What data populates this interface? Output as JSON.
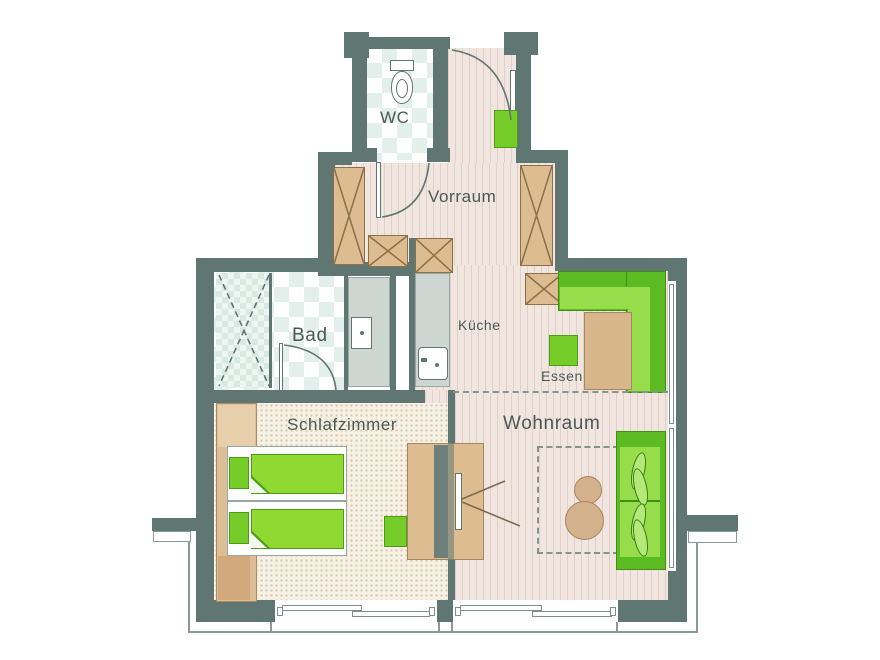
{
  "title": "Apartment floor plan",
  "rooms": [
    {
      "id": "wc",
      "label": "WC"
    },
    {
      "id": "vorraum",
      "label": "Vorraum"
    },
    {
      "id": "bad",
      "label": "Bad"
    },
    {
      "id": "kueche",
      "label": "Küche"
    },
    {
      "id": "essen",
      "label": "Essen"
    },
    {
      "id": "schlafzimmer",
      "label": "Schlafzimmer"
    },
    {
      "id": "wohnraum",
      "label": "Wohnraum"
    }
  ],
  "colors": {
    "wall": "#5F7672",
    "wood_floor": "#F1E5DF",
    "carpet": "#F6F1E4",
    "tile": "#E2EFEA",
    "furniture_tan": "#DCBC90",
    "green_bright": "#8FD932",
    "green_dark": "#5CBB22",
    "counter_gray": "#CDD6D1",
    "outline_gray": "#8A9A96",
    "text": "#4A5955"
  }
}
